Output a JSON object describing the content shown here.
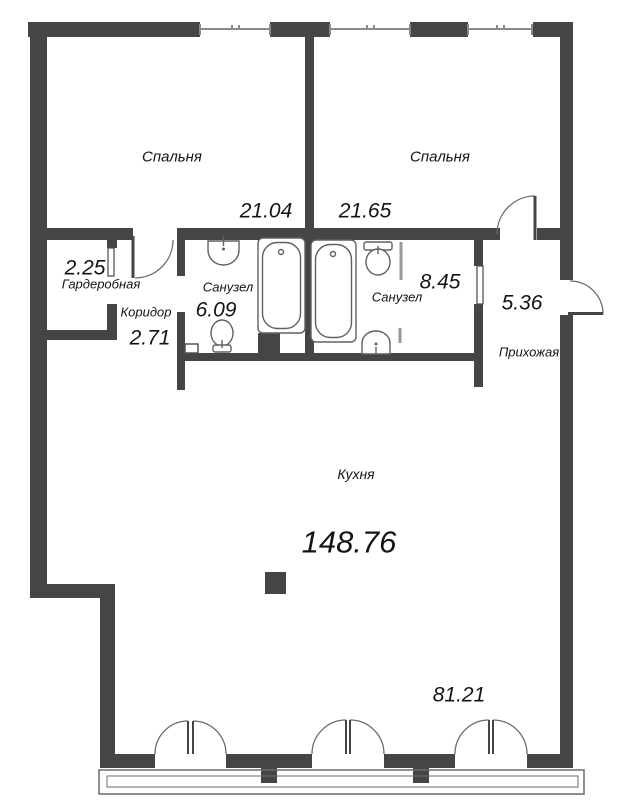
{
  "floorplan": {
    "rooms": {
      "bedroom1": {
        "label": "Спальня",
        "area": "21.04"
      },
      "bedroom2": {
        "label": "Спальня",
        "area": "21.65"
      },
      "wardrobe": {
        "label": "Гардеробная",
        "area": "2.25"
      },
      "corridor": {
        "label": "Коридор",
        "area": "2.71"
      },
      "bathroom1": {
        "label": "Санузел",
        "area": "6.09"
      },
      "bathroom2": {
        "label": "Санузел",
        "area": "8.45"
      },
      "hallway": {
        "label": "Прихожая",
        "area": "5.36"
      },
      "kitchen": {
        "label": "Кухня",
        "area": "148.76"
      },
      "terrace": {
        "area": "81.21"
      }
    },
    "colors": {
      "wall": "#454545",
      "fixture_line": "#666666",
      "window_line": "#8a8a8a",
      "text": "#141414"
    }
  }
}
